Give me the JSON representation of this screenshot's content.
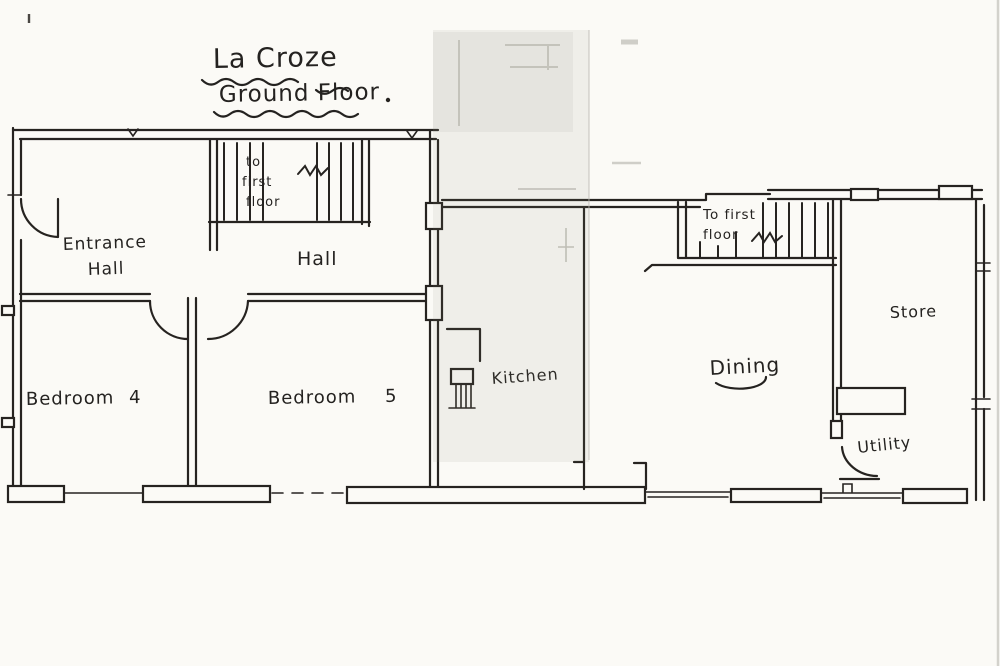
{
  "title": {
    "line1": "La Croze",
    "line2": "Ground Floor"
  },
  "stairs": {
    "left": {
      "line1": "to",
      "line2": "first",
      "line3": "floor"
    },
    "right": {
      "line1": "To first",
      "line2": "floor"
    }
  },
  "rooms": {
    "entrance_hall": {
      "line1": "Entrance",
      "line2": "Hall"
    },
    "hall": {
      "label": "Hall"
    },
    "bedroom4": {
      "label": "Bedroom 4"
    },
    "bedroom5": {
      "label": "Bedroom 5"
    },
    "kitchen": {
      "label": "Kitchen"
    },
    "dining": {
      "label": "Dining"
    },
    "store": {
      "label": "Store"
    },
    "utility": {
      "label": "Utility"
    }
  },
  "colors": {
    "ink": "#262320",
    "paper": "#fbfaf6",
    "scan_band": "#b9b7ab"
  }
}
